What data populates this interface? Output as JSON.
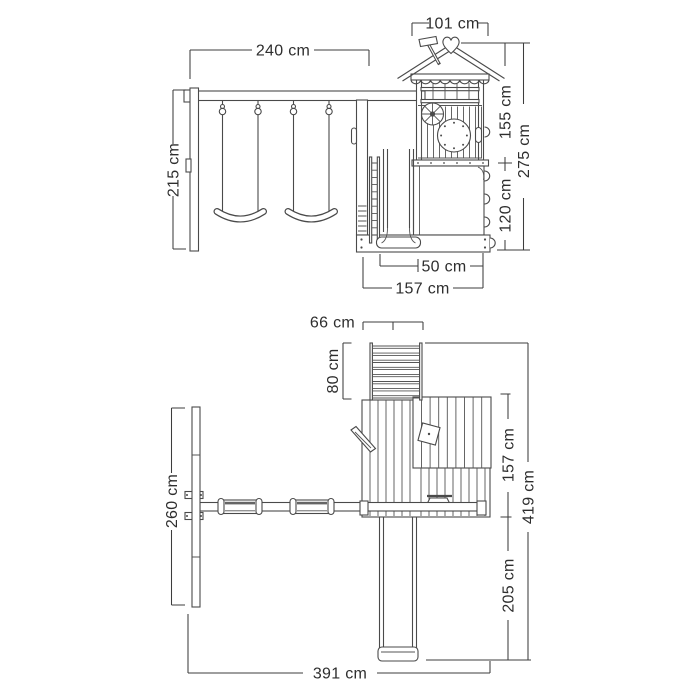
{
  "diagram": {
    "type": "playset-dimension-drawing",
    "views": [
      "side-elevation",
      "plan-view"
    ],
    "colors": {
      "background": "#ffffff",
      "line": "#4a4a4a",
      "text": "#2e2e2e"
    }
  },
  "side_view": {
    "dims": {
      "beam_width": "240 cm",
      "frame_height": "215 cm",
      "roof_width": "101 cm",
      "upper_height": "155 cm",
      "total_height": "275 cm",
      "platform_height": "120 cm",
      "slide_exit_width": "50 cm",
      "base_depth": "157 cm"
    }
  },
  "plan_view": {
    "dims": {
      "ladder_width": "66 cm",
      "ladder_depth": "80 cm",
      "frame_span": "260 cm",
      "tower_depth": "157 cm",
      "total_depth": "419 cm",
      "slide_length": "205 cm",
      "total_width": "391 cm"
    }
  }
}
